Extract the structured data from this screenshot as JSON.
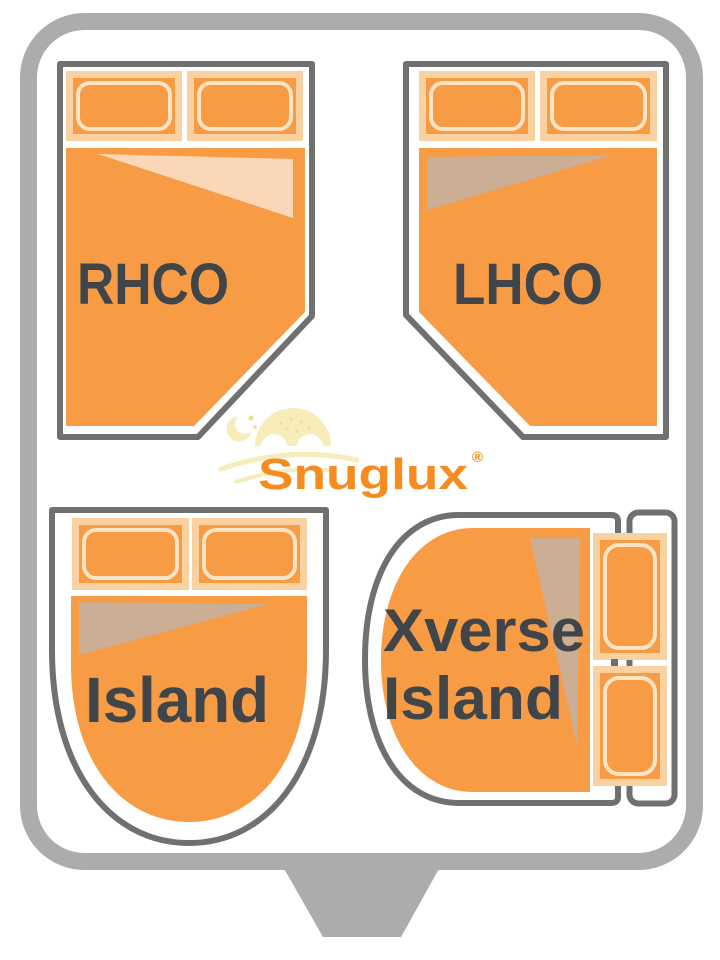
{
  "diagram": {
    "brand": {
      "name": "Snuglux",
      "trademark": "®"
    },
    "beds": {
      "rhco": {
        "label": "RHCO"
      },
      "lhco": {
        "label": "LHCO"
      },
      "island": {
        "label": "Island"
      },
      "xverse_island": {
        "label_line1": "Xverse",
        "label_line2": "Island"
      }
    },
    "colors": {
      "orange": "#F89B45",
      "pale_fold": "#FAD7B6",
      "tan_fold": "#CBAE94",
      "pillow_border": "#FAD2A2",
      "pillow_outline": "#FBE4C4",
      "bed_outline": "#707070",
      "frame_gray": "#ACACAC",
      "label_text": "#40454A",
      "logo_orange": "#F68B20",
      "logo_pale_yellow": "#F7ECBA",
      "logo_pale_accent": "#EFDF9C",
      "white": "#FFFFFF"
    }
  }
}
